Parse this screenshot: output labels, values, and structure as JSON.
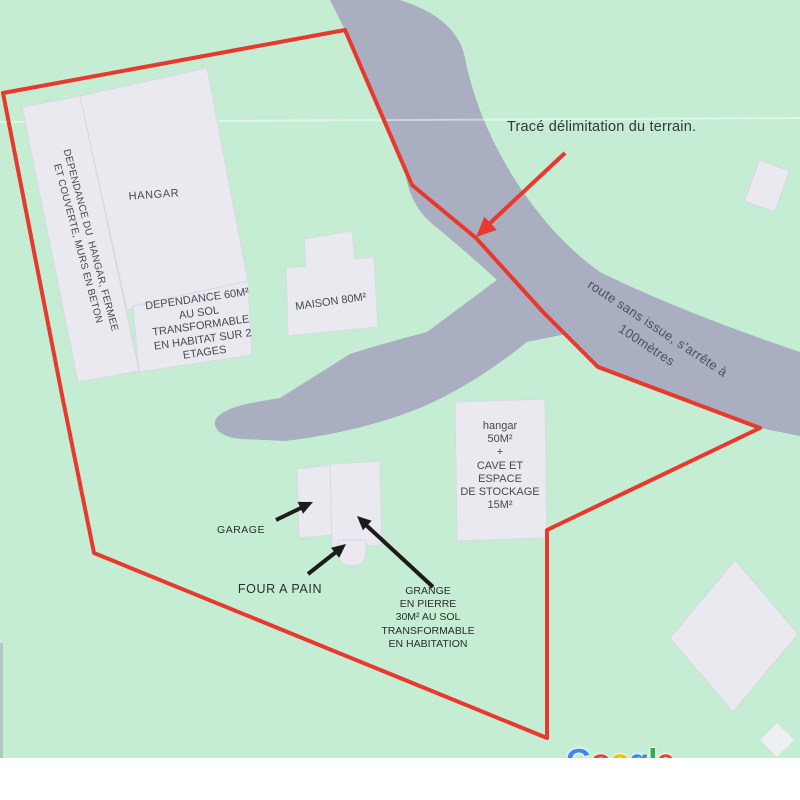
{
  "colors": {
    "terrain_green": "#c4edd3",
    "road_gray": "#a9afc0",
    "building_fill": "#e9e9ef",
    "building_stroke": "#d8d9e2",
    "boundary_red": "#e8392e",
    "arrow_black": "#1c1c1c",
    "building_label": "#46494f",
    "road_label": "#49505f",
    "annotation": "#2c2c2c",
    "strip_white": "#ffffff"
  },
  "annotations": {
    "trace_title": "Tracé délimitation du terrain.",
    "garage": "GARAGE",
    "four_a_pain": "FOUR A PAIN",
    "grange_lines": [
      "GRANGE",
      "EN PIERRE",
      "30M² AU SOL",
      "TRANSFORMABLE",
      "EN HABITATION"
    ]
  },
  "road": {
    "label_lines": [
      "route sans issue, s'arrête à",
      "100mètres"
    ]
  },
  "buildings": {
    "hangar": "HANGAR",
    "hangar_annex_lines": [
      "DEPENDANCE DU  HANGAR, FERMEE",
      "ET COUVERTE, MURS EN BETON"
    ],
    "dependance_lines": [
      "DEPENDANCE 60M²",
      "AU SOL",
      "TRANSFORMABLE",
      "EN HABITAT SUR 2",
      "ETAGES"
    ],
    "maison": "MAISON 80M²",
    "hangar50_lines": [
      "hangar",
      "50M²",
      "+",
      "CAVE ET",
      "ESPACE",
      "DE STOCKAGE",
      "15M²"
    ]
  },
  "watermark": {
    "letters": [
      {
        "ch": "G",
        "style": "color:#4285F4"
      },
      {
        "ch": "o",
        "style": "color:#EA4335"
      },
      {
        "ch": "o",
        "style": "color:#FBBC05"
      },
      {
        "ch": "g",
        "style": "color:#4285F4"
      },
      {
        "ch": "l",
        "style": "color:#34A853"
      },
      {
        "ch": "e",
        "style": "color:#EA4335"
      }
    ]
  }
}
